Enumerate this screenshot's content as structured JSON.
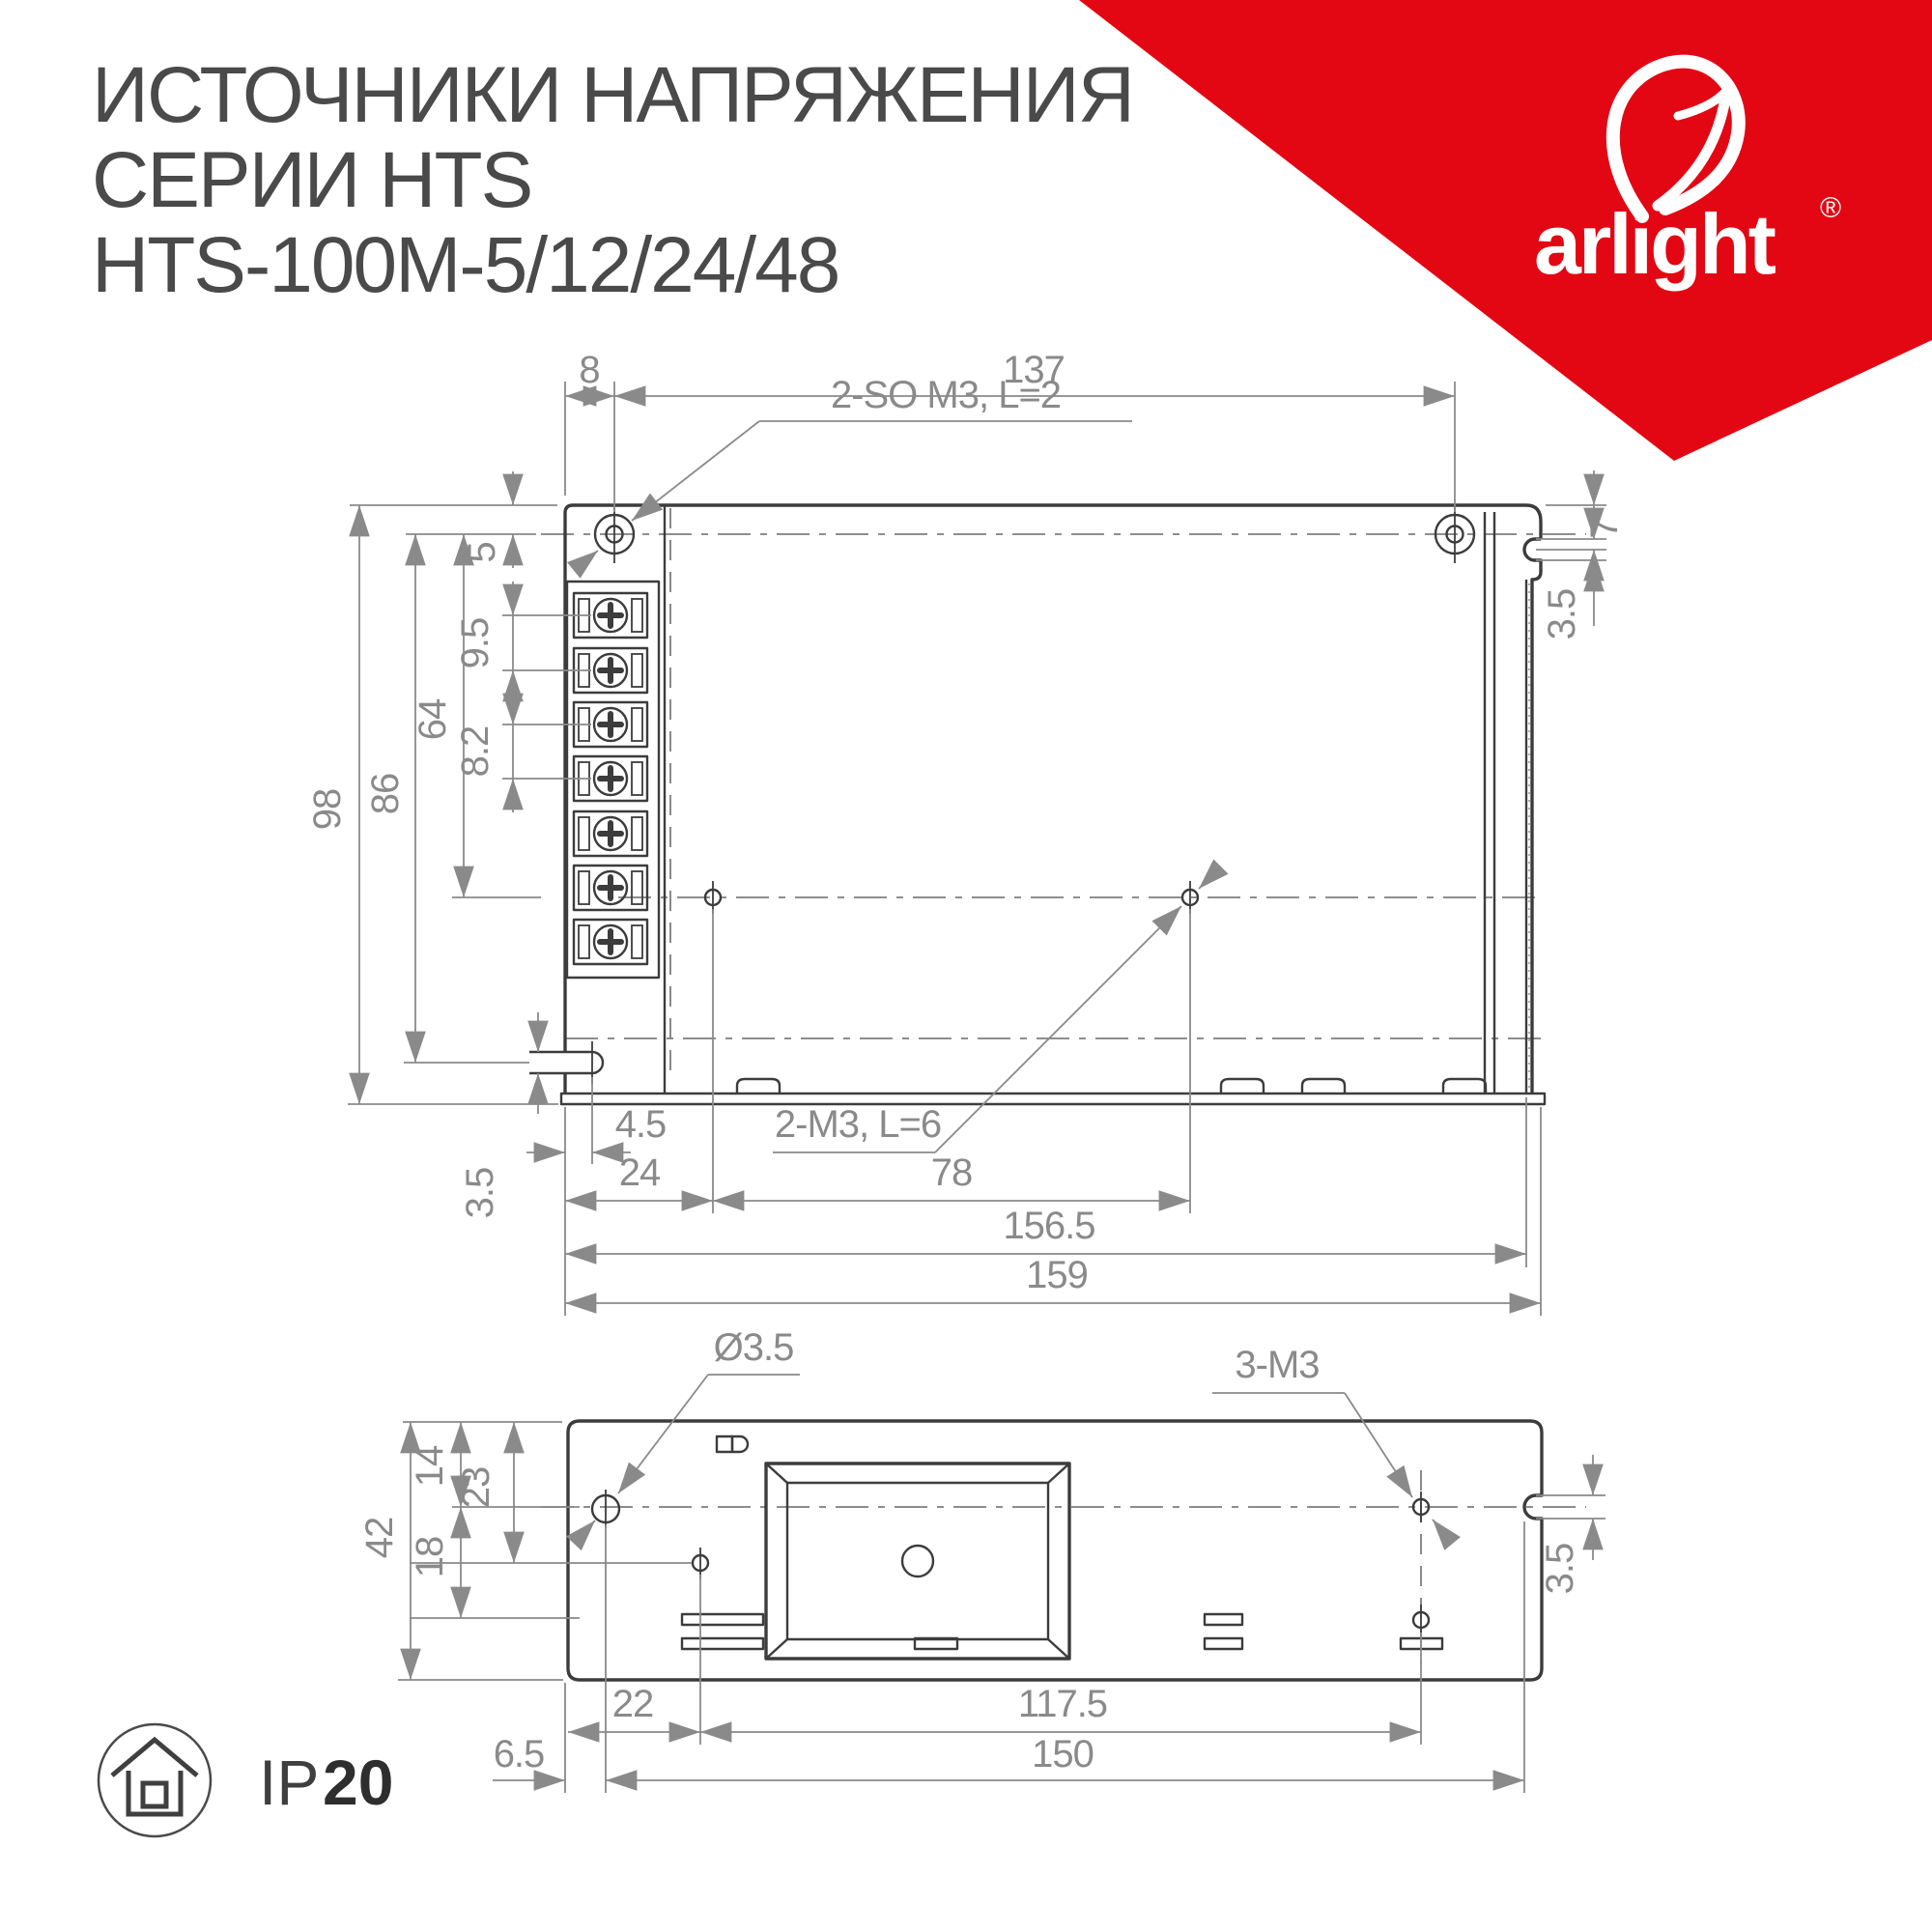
{
  "title": {
    "line1": "ИСТОЧНИКИ НАПРЯЖЕНИЯ",
    "line2": "СЕРИИ HTS",
    "line3": "HTS-100M-5/12/24/48"
  },
  "logo": {
    "brand": "arlight",
    "registered": "®"
  },
  "colors": {
    "accent_red": "#E30613",
    "line_dark": "#3C3C3C",
    "line_dim": "#8A8A8A",
    "title_text": "#4A4A4A"
  },
  "top_view": {
    "labels": {
      "top_screws": "2-SO M3, L=2",
      "mid_screws": "2-M3, L=6"
    },
    "dims": {
      "d8": "8",
      "d137": "137",
      "d5": "5",
      "d95": "9.5",
      "d64": "64",
      "d82": "8.2",
      "d86": "86",
      "d98": "98",
      "d7": "7",
      "d35_right": "3.5",
      "d35_bottom": "3.5",
      "d45": "4.5",
      "d24": "24",
      "d78": "78",
      "d1565": "156.5",
      "d159": "159"
    }
  },
  "bottom_view": {
    "labels": {
      "hole": "Ø3.5",
      "screws": "3-M3"
    },
    "dims": {
      "d42": "42",
      "d14": "14",
      "d23": "23",
      "d18": "18",
      "d35": "3.5",
      "d22": "22",
      "d1175": "117.5",
      "d65": "6.5",
      "d150": "150"
    }
  },
  "badge": {
    "ip": "IP",
    "rating": "20"
  }
}
